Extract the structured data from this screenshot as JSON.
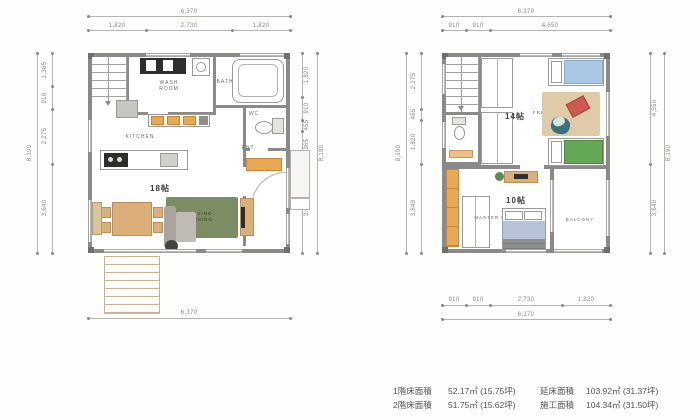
{
  "floor1": {
    "dims": {
      "top_overall": "6,370",
      "top_segments": [
        "1,820",
        "2,730",
        "1,820"
      ],
      "left_overall": "8,190",
      "left_segments": [
        "1,365",
        "910",
        "2,275",
        "3,640"
      ],
      "right_overall": "8,190",
      "right_segments": [
        "1,820",
        "910",
        "455",
        "1,365",
        "3,640"
      ],
      "bottom_overall": "6,370"
    },
    "labels": {
      "wash_room": "WASH ROOM",
      "bath": "BATH",
      "wc": "WC",
      "kitchen": "KITCHEN",
      "ent": "ENT",
      "size": "18帖",
      "living_dining": "LIVING DINING"
    }
  },
  "floor2": {
    "dims": {
      "top_overall": "6,370",
      "top_segments": [
        "910",
        "910",
        "4,550"
      ],
      "left_overall": "8,190",
      "left_segments": [
        "2,275",
        "455",
        "1,820",
        "3,640"
      ],
      "right_overall": "8,190",
      "right_segments": [
        "4,550",
        "3,640"
      ],
      "bottom_segments": [
        "910",
        "910",
        "2,730",
        "1,820"
      ],
      "bottom_overall": "6,370"
    },
    "labels": {
      "size_kids": "14帖",
      "free_space": "FREE SPACE",
      "size_master": "10帖",
      "master_bedroom": "MASTER BEDROOM",
      "balcony": "BALCONY"
    }
  },
  "summary": {
    "items": [
      {
        "label": "1階床面積",
        "value": "52.17㎡ (15.75坪)"
      },
      {
        "label": "2階床面積",
        "value": "51.75㎡ (15.62坪)"
      },
      {
        "label": "延床面積",
        "value": "103.92㎡ (31.37坪)"
      },
      {
        "label": "施工面積",
        "value": "104.34㎡ (31.50坪)"
      }
    ]
  },
  "colors": {
    "wall": "#8a8a88",
    "living_rug_green": "#7d8d63",
    "wood_tan": "#dcaf78",
    "cabinet_orange": "#e8a854",
    "bed_blue": "#aac7e6",
    "bed_green": "#63a757",
    "master_bed_blue": "#b7c3d6",
    "free_space_rug": "#e0cba8",
    "cushion_red": "#cd5a50",
    "bean_bag_teal": "#3c7080"
  }
}
